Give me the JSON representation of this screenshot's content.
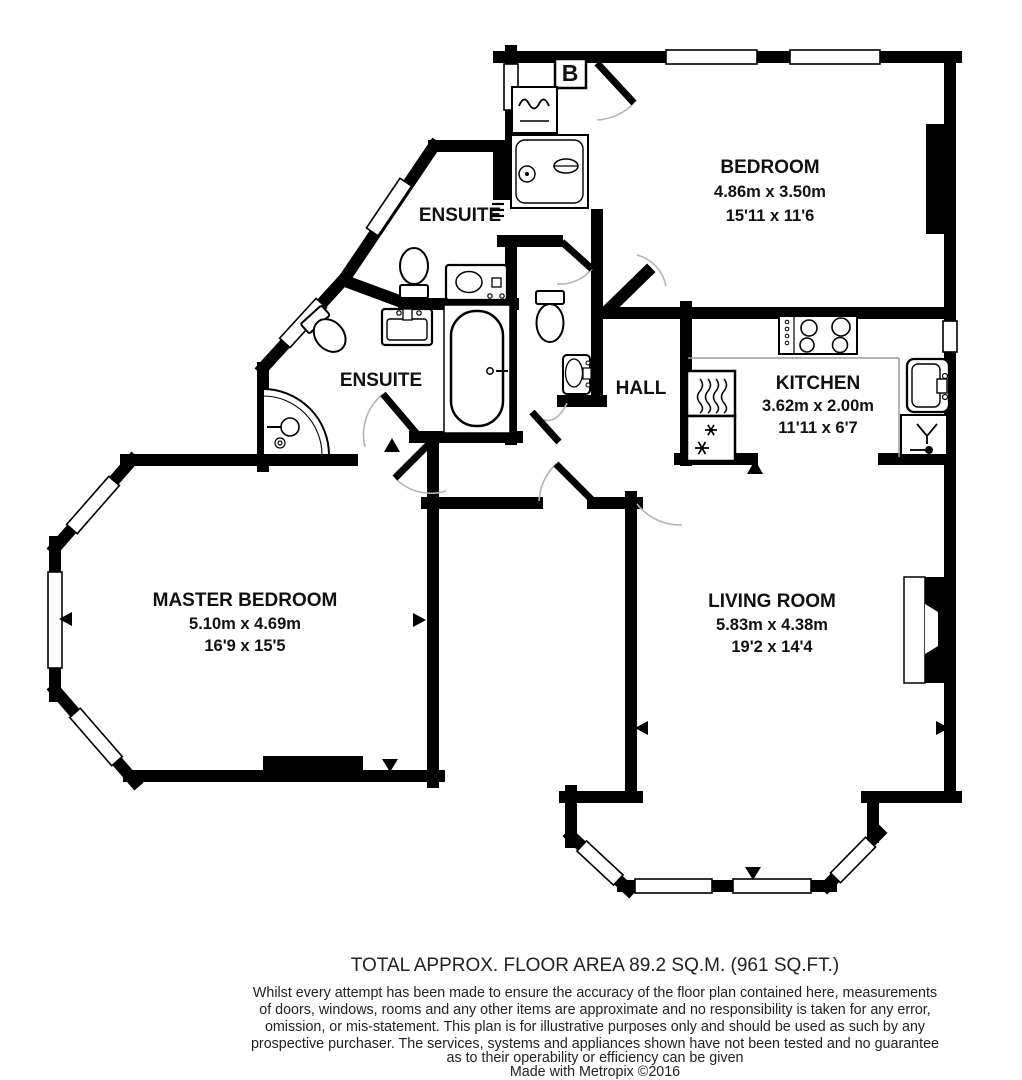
{
  "plan": {
    "rooms": {
      "bedroom": {
        "name": "BEDROOM",
        "metric": "4.86m x 3.50m",
        "imperial": "15'11 x 11'6"
      },
      "ensuite_top": {
        "name": "ENSUITE"
      },
      "ensuite_lower": {
        "name": "ENSUITE"
      },
      "hall": {
        "name": "HALL"
      },
      "kitchen": {
        "name": "KITCHEN",
        "metric": "3.62m x 2.00m",
        "imperial": "11'11 x 6'7"
      },
      "master_bedroom": {
        "name": "MASTER BEDROOM",
        "metric": "5.10m x 4.69m",
        "imperial": "16'9 x 15'5"
      },
      "living_room": {
        "name": "LIVING ROOM",
        "metric": "5.83m x 4.38m",
        "imperial": "19'2 x 14'4"
      }
    },
    "labels": {
      "boiler": "B"
    },
    "colors": {
      "wall": "#000000",
      "background": "#ffffff",
      "door_arc": "#b4b4b4"
    }
  },
  "footer": {
    "total_area": "TOTAL APPROX. FLOOR AREA 89.2 SQ.M. (961 SQ.FT.)",
    "disclaimer_lines": [
      "Whilst every attempt has been made to ensure the accuracy of the floor plan contained here, measurements",
      "of doors, windows, rooms and any other items are approximate and no responsibility is taken for any error,",
      "omission, or mis-statement. This plan is for illustrative purposes only and should be used as such by any",
      "prospective purchaser. The services, systems and appliances shown have not been tested and no guarantee",
      "as to their operability or efficiency can be given"
    ],
    "credit": "Made with Metropix ©2016"
  }
}
